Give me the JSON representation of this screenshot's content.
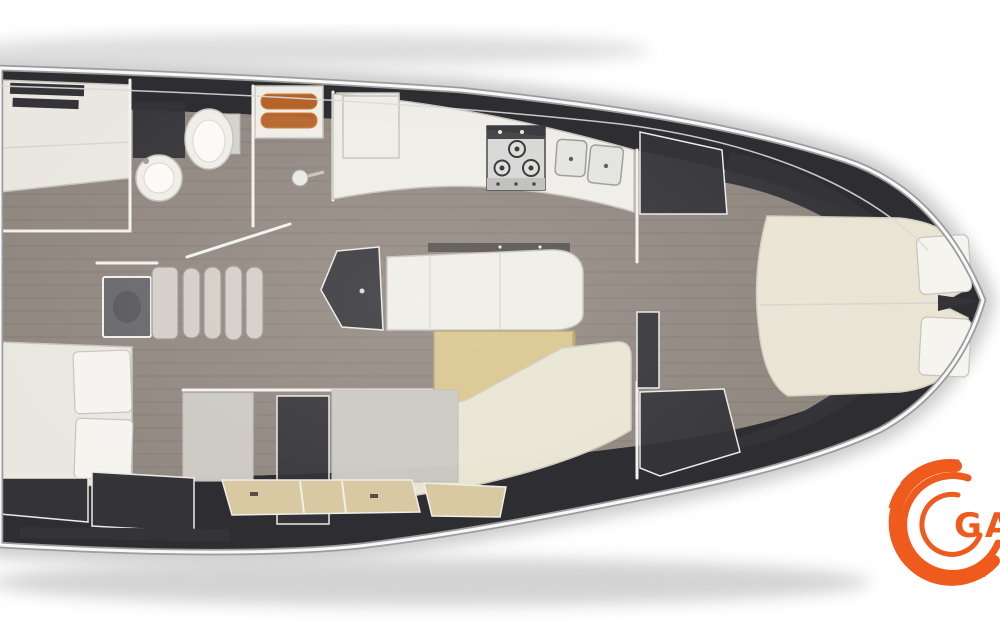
{
  "page": {
    "background_color": "#ffffff"
  },
  "logo": {
    "text": "GAC"
  },
  "colors": {
    "bg": "#ffffff",
    "halo": "#bdbdbd",
    "hull_dark": "#2e2e32",
    "chrome": "#f8f8f8",
    "chrome_shadow": "#9c9c9c",
    "floor": "#8f867e",
    "wall": "#f2f1ed",
    "furniture_white": "#efede7",
    "furniture_border": "#c6c3bb",
    "mattress": "#e9e7e0",
    "pillow": "#f5f4ef",
    "bed_cream": "#e9e4d4",
    "table_tan": "#d8c58c",
    "table_tan_dark": "#b3a26e",
    "bench_cream": "#e9e5d3",
    "locker_dark": "#333338",
    "panel_gray": "#cbc8c2",
    "tan_cabinet": "#d9c9a2",
    "steel": "#d6d6d4",
    "steel_dark": "#3c3c40",
    "step": "#d3cec7",
    "hatch": "#66666a",
    "wood_slat": "#b4632a",
    "wood_slat_light": "#d07c3a",
    "logo_orange": "#ef5a1d"
  },
  "diagram": {
    "type": "yacht-interior-floor-plan",
    "orientation": "bow-right",
    "areas": [
      "aft-cabin-port",
      "aft-heads-with-shower",
      "companionway-steps",
      "galley",
      "salon",
      "mid-lower-compartments",
      "aft-cabin-starboard",
      "forward-cabin"
    ],
    "fixtures": [
      "double-bed-aft-port",
      "toilet",
      "washbasin",
      "shower-wood-grate",
      "refrigerator-box",
      "stove-3-burner",
      "double-sink",
      "nav-locker",
      "l-shaped-sofa",
      "dinette-table",
      "l-shaped-bench",
      "tan-lower-cabinets",
      "double-bed-aft-starboard",
      "v-berth-double-bed",
      "wardrobes",
      "bow-point"
    ]
  }
}
